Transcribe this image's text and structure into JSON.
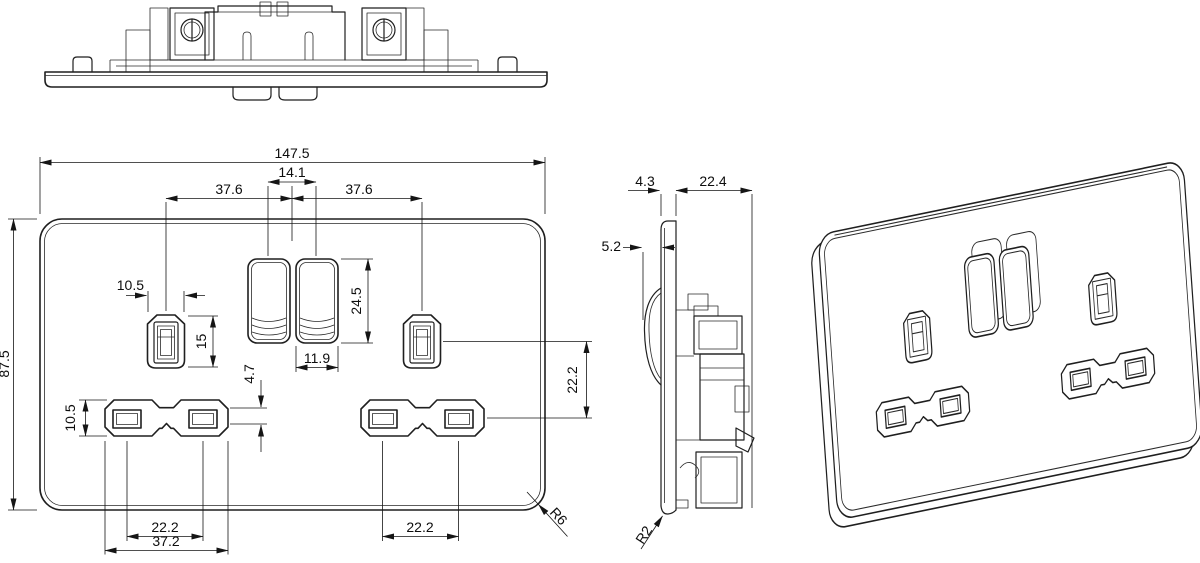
{
  "drawing": {
    "type": "engineering-dimension-drawing",
    "subject": "double-switched-socket-faceplate",
    "line_color": "#1f1f1f",
    "background": "#ffffff"
  },
  "front_view": {
    "dims": {
      "overall_width": "147.5",
      "overall_height": "87.5",
      "rocker_pitch": "14.1",
      "earth_offset_left": "37.6",
      "earth_offset_right": "37.6",
      "earth_aperture_width": "10.5",
      "earth_aperture_height": "15",
      "rocker_height": "24.5",
      "rocker_width": "11.9",
      "bridge_height": "4.7",
      "ln_aperture_height": "10.5",
      "ln_pin_pitch_left": "22.2",
      "ln_aperture_span": "37.2",
      "ln_pin_pitch_right": "22.2",
      "earth_to_ln_pitch": "22.2",
      "corner_radius": "R6"
    }
  },
  "side_view": {
    "dims": {
      "plate_thickness": "4.3",
      "mechanism_depth": "22.4",
      "rocker_protrusion": "5.2",
      "edge_radius": "R2"
    }
  }
}
